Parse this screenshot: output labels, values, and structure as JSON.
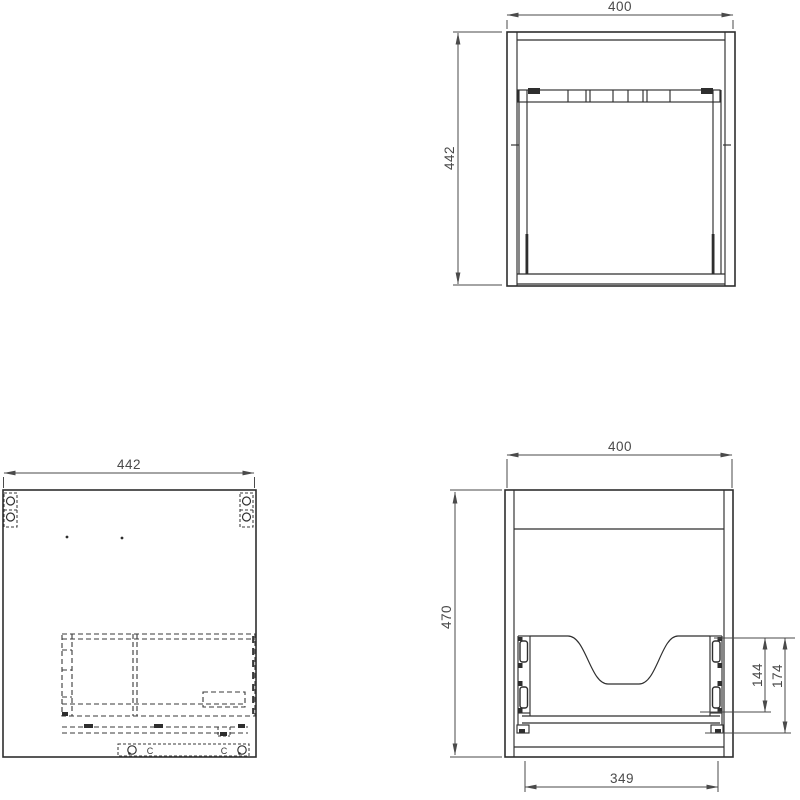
{
  "drawing": {
    "background": "#ffffff",
    "line_color": "#2e2e2e",
    "dim_color": "#4a4a4a",
    "plan_view": {
      "dim_width": "400",
      "dim_depth": "442"
    },
    "side_view": {
      "dim_depth": "442",
      "clip_left": "C",
      "clip_right": "C"
    },
    "front_view": {
      "dim_width": "400",
      "dim_height": "470",
      "dim_cutout_height": "144",
      "dim_rail_height": "174",
      "dim_drawer_width": "349"
    }
  }
}
